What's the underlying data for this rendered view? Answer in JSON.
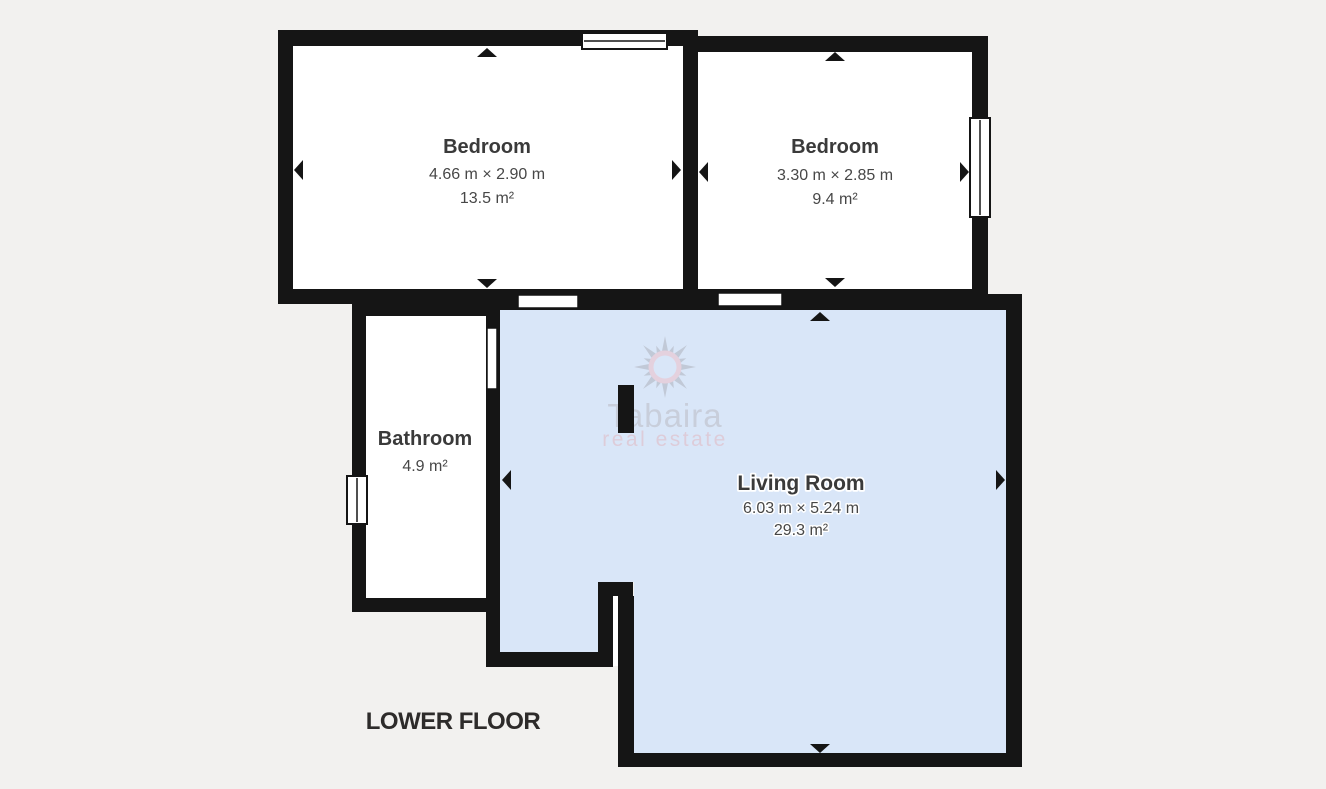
{
  "floor_plan": {
    "floor_label": "LOWER FLOOR",
    "rooms": [
      {
        "name": "Bedroom",
        "dimensions": "4.66 m × 2.90 m",
        "area": "13.5 m²"
      },
      {
        "name": "Bedroom",
        "dimensions": "3.30 m × 2.85 m",
        "area": "9.4 m²"
      },
      {
        "name": "Bathroom",
        "area": "4.9 m²"
      },
      {
        "name": "Living Room",
        "dimensions": "6.03 m × 5.24 m",
        "area": "29.3 m²"
      }
    ],
    "watermark": {
      "brand": "Tabaira",
      "tagline": "real estate"
    },
    "colors": {
      "background": "#f2f1ef",
      "wall": "#151515",
      "room_fill": "#ffffff",
      "living_room_fill": "#d9e6f8",
      "label_text": "#3a3a3a",
      "floor_label_text": "#2d2b2a",
      "watermark_gray": "#c5c9d4",
      "watermark_pink": "#dfc6d2"
    }
  }
}
